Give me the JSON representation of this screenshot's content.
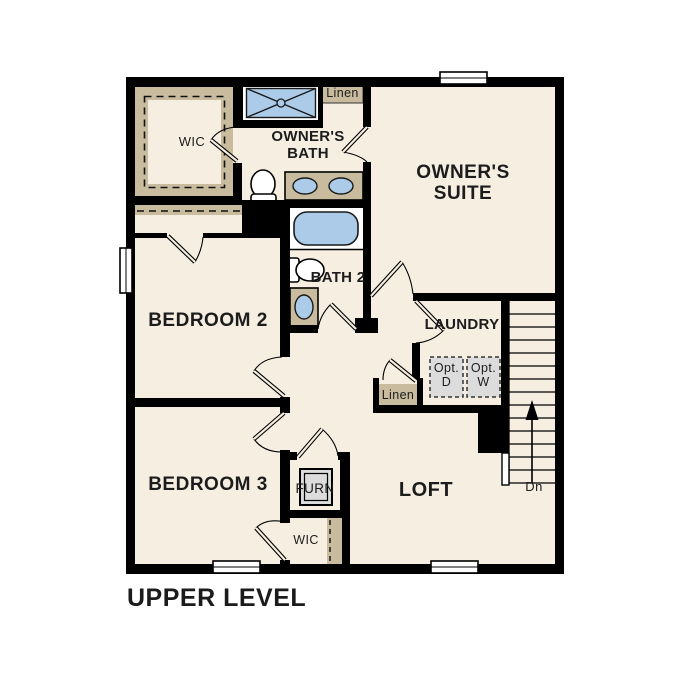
{
  "plan_title": "UPPER LEVEL",
  "labels": {
    "wic_top": "WIC",
    "owners_bath": "OWNER'S BATH",
    "linen_top": "Linen",
    "owners_suite": "OWNER'S SUITE",
    "bedroom_2": "BEDROOM 2",
    "bath_2": "BATH 2",
    "laundry": "LAUNDRY",
    "opt_dryer": "Opt. D",
    "opt_washer": "Opt. W",
    "linen_mid": "Linen",
    "bedroom_3": "BEDROOM 3",
    "furnace": "FURN",
    "wic_bottom": "WIC",
    "loft": "LOFT",
    "stairs_down": "Dn"
  },
  "colors": {
    "background": "#ffffff",
    "floor_cream": "#f5eee1",
    "closet_tan": "#c8bb9e",
    "fixture_blue": "#abcbe9",
    "appliance_gray": "#dcdcdc",
    "wall_black": "#000000"
  }
}
